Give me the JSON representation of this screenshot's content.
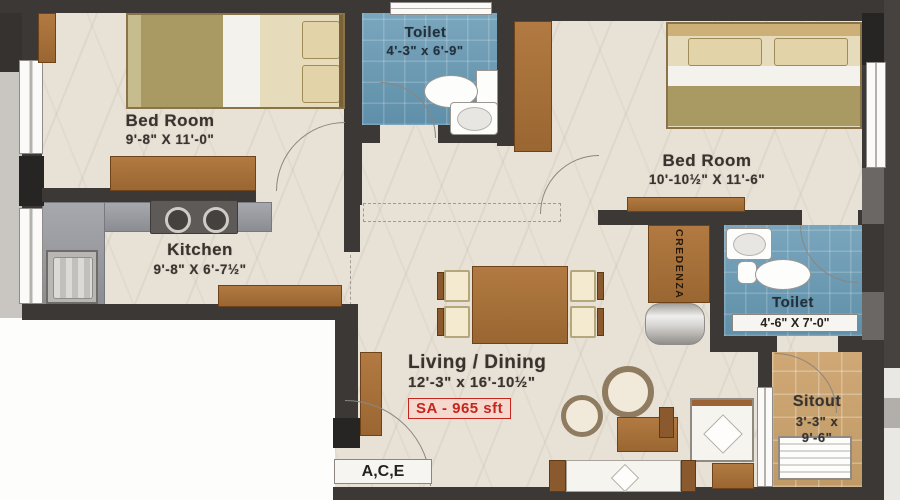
{
  "rooms": {
    "bedroom1": {
      "name": "Bed Room",
      "dims": "9'-8\" X 11'-0\""
    },
    "toilet1": {
      "name": "Toilet",
      "dims": "4'-3\" x 6'-9\""
    },
    "bedroom2": {
      "name": "Bed Room",
      "dims": "10'-10½\" X 11'-6\""
    },
    "kitchen": {
      "name": "Kitchen",
      "dims": "9'-8\" X 6'-7½\""
    },
    "living": {
      "name": "Living / Dining",
      "dims": "12'-3\" x 16'-10½\""
    },
    "toilet2": {
      "name": "Toilet",
      "dims": "4'-6\" X 7'-0\""
    },
    "sitout": {
      "name": "Sitout",
      "dims_line1": "3'-3\" x",
      "dims_line2": "9'-6\""
    }
  },
  "labels": {
    "area": "SA - 965 sft",
    "entrance": "A,C,E",
    "credenza": "CREDENZA"
  },
  "colors": {
    "wall": "#3b3835",
    "floor": "#e7e1d6",
    "tile_blue": "#6f9db6",
    "counter_gray": "#999ba0",
    "wood": "#a9743f",
    "sitout_tan": "#c9a372",
    "accent_red": "#c4261d"
  }
}
